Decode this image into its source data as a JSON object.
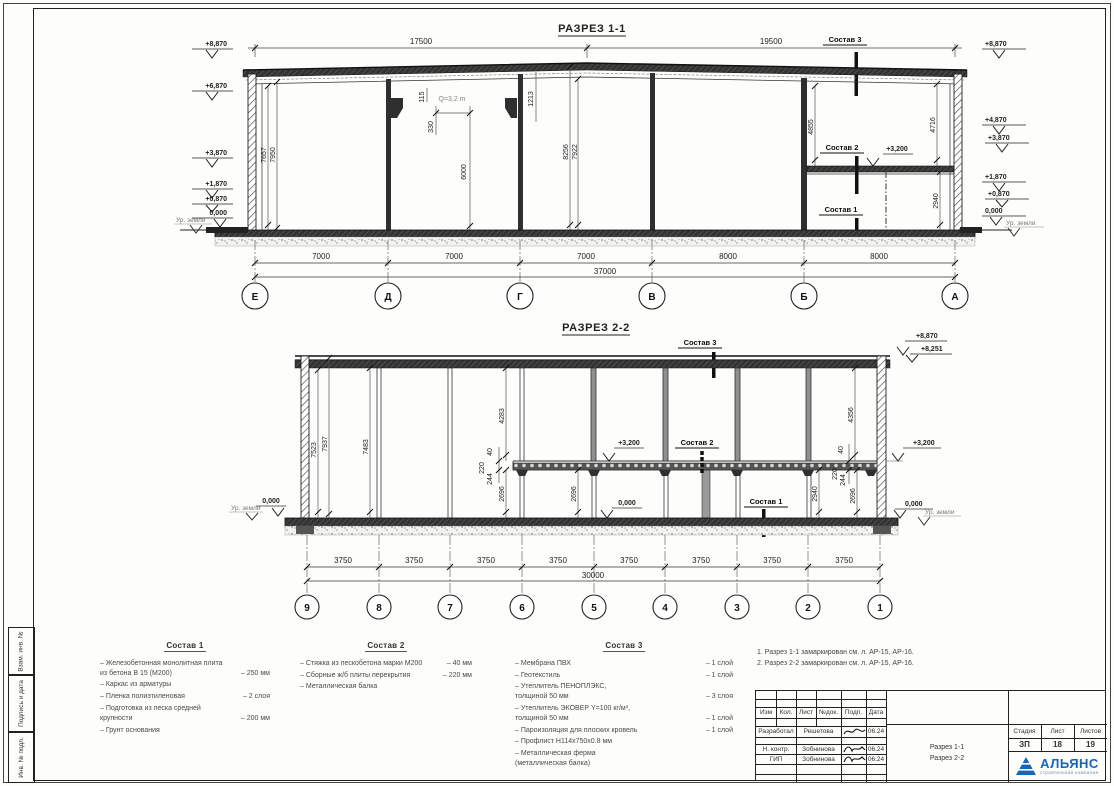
{
  "frame": {
    "strips": [
      "Взам. инв. №",
      "Подпись  и  дата",
      "Инв. № подл."
    ]
  },
  "shared": {
    "ground_label": "Ур. земли",
    "zero_level": "0,000",
    "mezz_level": "+3,200",
    "sostav1": "Состав 1",
    "sostav2": "Состав 2",
    "sostav3": "Состав 3"
  },
  "section1": {
    "title": "РАЗРЕЗ 1-1",
    "dim_top_left": "17500",
    "dim_top_right": "19500",
    "dim_total": "37000",
    "bottom_dims": [
      "7000",
      "7000",
      "7000",
      "8000",
      "8000"
    ],
    "axes": [
      "Е",
      "Д",
      "Г",
      "В",
      "Б",
      "А"
    ],
    "left_elev": {
      "e8870": "+8,870",
      "e6870": "+6,870",
      "e3870": "+3,870",
      "e1870": "+1,870",
      "e0870": "+0,870",
      "e0": "0,000"
    },
    "right_elev": {
      "e8870": "+8,870",
      "e4870": "+4,870",
      "e3870": "+3,870",
      "e1870": "+1,870",
      "e0870": "+0,870",
      "e0": "0,000"
    },
    "crane_label": "Q=3,2 m",
    "dims": {
      "d7657": "7657",
      "d7950": "7950",
      "d115": "115",
      "d330": "330",
      "d1213": "1213",
      "d6000": "6000",
      "d8256": "8256",
      "d7922": "7922",
      "d4855": "4855",
      "d4716": "4716",
      "d2940": "2940"
    }
  },
  "section2": {
    "title": "РАЗРЕЗ 2-2",
    "dim_total": "30000",
    "bottom_dim": "3750",
    "axes": [
      "9",
      "8",
      "7",
      "6",
      "5",
      "4",
      "3",
      "2",
      "1"
    ],
    "elev": {
      "top_parapet": "+8,870",
      "top_roof": "+8,251"
    },
    "dims": {
      "d7523": "7523",
      "d7937": "7937",
      "d7483": "7483",
      "d4283": "4283",
      "d4356": "4356",
      "d40": "40",
      "d220": "220",
      "d244": "244",
      "d2696": "2696",
      "d2940": "2940"
    }
  },
  "legend1": {
    "title": "Состав 1",
    "items": [
      {
        "text": "– Железобетонная  монолитная плита\nиз бетона В 15 (М200)",
        "value": "– 250 мм"
      },
      {
        "text": "– Каркас из арматуры",
        "value": ""
      },
      {
        "text": "– Пленка полиэтиленовая",
        "value": "– 2 слоя"
      },
      {
        "text": "– Подготовка из песка средней\nкрупности",
        "value": "– 200 мм"
      },
      {
        "text": "– Грунт основания",
        "value": ""
      }
    ]
  },
  "legend2": {
    "title": "Состав 2",
    "items": [
      {
        "text": "– Стяжка из пескобетона марки М200",
        "value": "– 40 мм"
      },
      {
        "text": "– Сборные ж/б плиты перекрытия",
        "value": "– 220 мм"
      },
      {
        "text": "– Металлическая балка",
        "value": ""
      }
    ]
  },
  "legend3": {
    "title": "Состав 3",
    "items": [
      {
        "text": "– Мембрана ПВХ",
        "value": "– 1 слой"
      },
      {
        "text": "– Геотекстиль",
        "value": "– 1 слой"
      },
      {
        "text": "– Утеплитель ПЕНОПЛЭКС,\nтолщиной 50 мм",
        "value": "– 3 слоя"
      },
      {
        "text": "– Утеплитель ЭКОВЕР Y=100 кг/м³,\nтолщиной 50 мм",
        "value": "– 1 слой"
      },
      {
        "text": "– Пароизоляция для плоских кровель",
        "value": "– 1 слой"
      },
      {
        "text": "– Профлист  Н114х750х0.8 мм",
        "value": ""
      },
      {
        "text": "– Металлическая ферма\n(металлическая балка)",
        "value": ""
      }
    ]
  },
  "notes": {
    "line1": "1. Разрез 1-1 замаркирован см. л. АР-15, АР-16.",
    "line2": "2. Разрез 2-2 замаркирован см. л. АР-15, АР-16."
  },
  "stamp": {
    "header_cols": [
      "Изм",
      "Кол.",
      "Лист",
      "№док.",
      "Подп.",
      "Дата"
    ],
    "rows": [
      {
        "role": "Разработал",
        "name": "Решетова",
        "date": "06.24"
      },
      {
        "role": "Н. контр.",
        "name": "Зобнинова",
        "date": "06.24"
      },
      {
        "role": "ГИП",
        "name": "Зобнинова",
        "date": "06.24"
      }
    ],
    "doc_title_line1": "Разрез 1-1",
    "doc_title_line2": "Разрез 2-2",
    "stage_label": "Стадия",
    "sheet_label": "Лист",
    "sheets_label": "Листов",
    "stage": "ЗП",
    "sheet": "18",
    "sheets": "19",
    "logo_name": "АЛЬЯНС",
    "logo_subtitle": "строительная компания"
  }
}
